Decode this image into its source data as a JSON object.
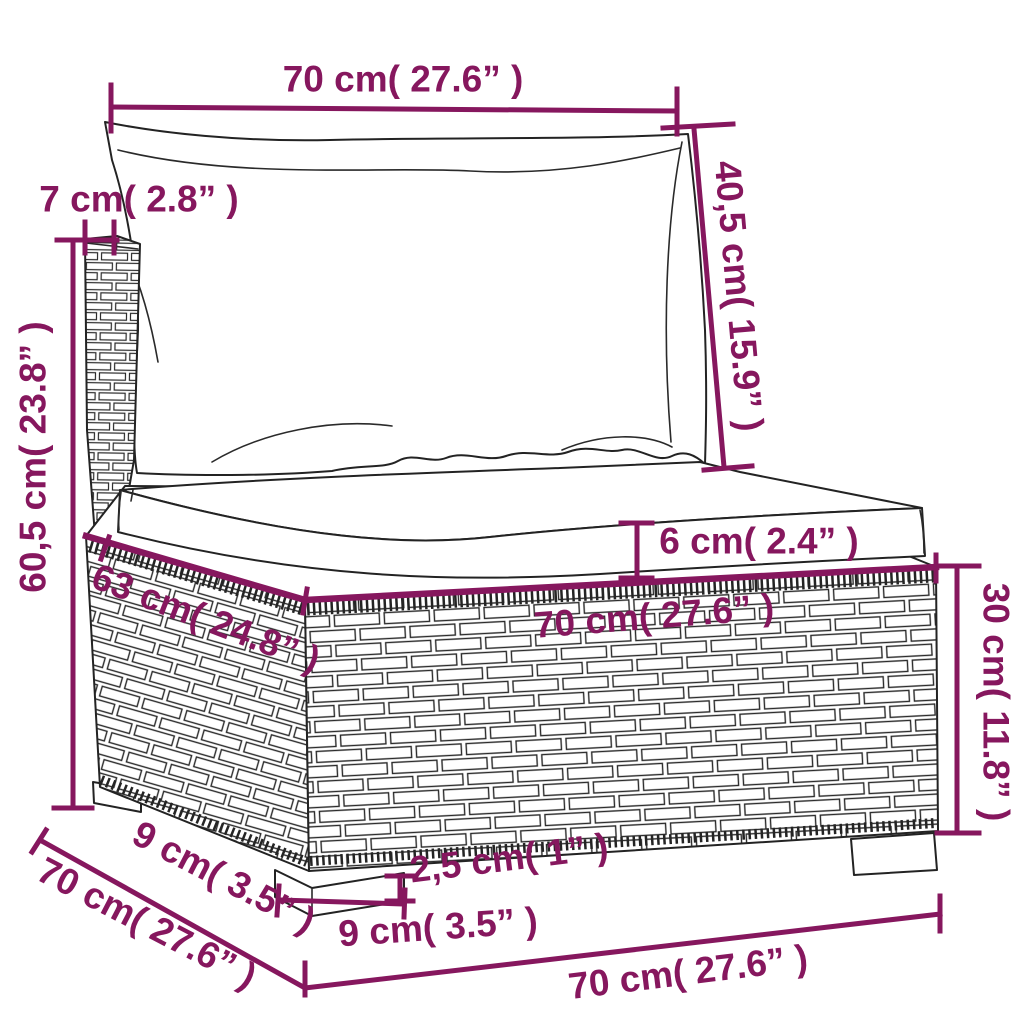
{
  "diagram": {
    "kind": "furniture-dimension-diagram",
    "subject": "poly-rattan-sofa-section-with-cushions",
    "colors": {
      "dimension_accent": "#86175e",
      "line_art": "#232323",
      "background": "#ffffff"
    },
    "labels": {
      "back_width": "70 cm( 27.6” )",
      "back_height": "40,5 cm( 15.9” )",
      "back_thickness": "7 cm( 2.8” )",
      "total_height": "60,5 cm( 23.8” )",
      "cushion_thickness": "6 cm( 2.4” )",
      "seat_depth": "63 cm( 24.8” )",
      "seat_width": "70 cm( 27.6” )",
      "base_height": "30 cm( 11.8” )",
      "leg_depth": "9 cm( 3.5” )",
      "depth_total": "70 cm( 27.6” )",
      "leg_height": "2,5 cm( 1” )",
      "leg_width": "9 cm( 3.5” )",
      "width_total": "70 cm( 27.6” )"
    },
    "measurements": [
      {
        "name": "back-cushion-width",
        "cm": "70",
        "inches": "27.6"
      },
      {
        "name": "back-cushion-height",
        "cm": "40,5",
        "inches": "15.9"
      },
      {
        "name": "back-panel-thickness",
        "cm": "7",
        "inches": "2.8"
      },
      {
        "name": "total-height",
        "cm": "60,5",
        "inches": "23.8"
      },
      {
        "name": "seat-cushion-thickness",
        "cm": "6",
        "inches": "2.4"
      },
      {
        "name": "seat-depth",
        "cm": "63",
        "inches": "24.8"
      },
      {
        "name": "seat-width",
        "cm": "70",
        "inches": "27.6"
      },
      {
        "name": "base-height",
        "cm": "30",
        "inches": "11.8"
      },
      {
        "name": "leg-depth",
        "cm": "9",
        "inches": "3.5"
      },
      {
        "name": "depth-total",
        "cm": "70",
        "inches": "27.6"
      },
      {
        "name": "leg-height",
        "cm": "2,5",
        "inches": "1"
      },
      {
        "name": "leg-width",
        "cm": "9",
        "inches": "3.5"
      },
      {
        "name": "width-total",
        "cm": "70",
        "inches": "27.6"
      }
    ]
  }
}
